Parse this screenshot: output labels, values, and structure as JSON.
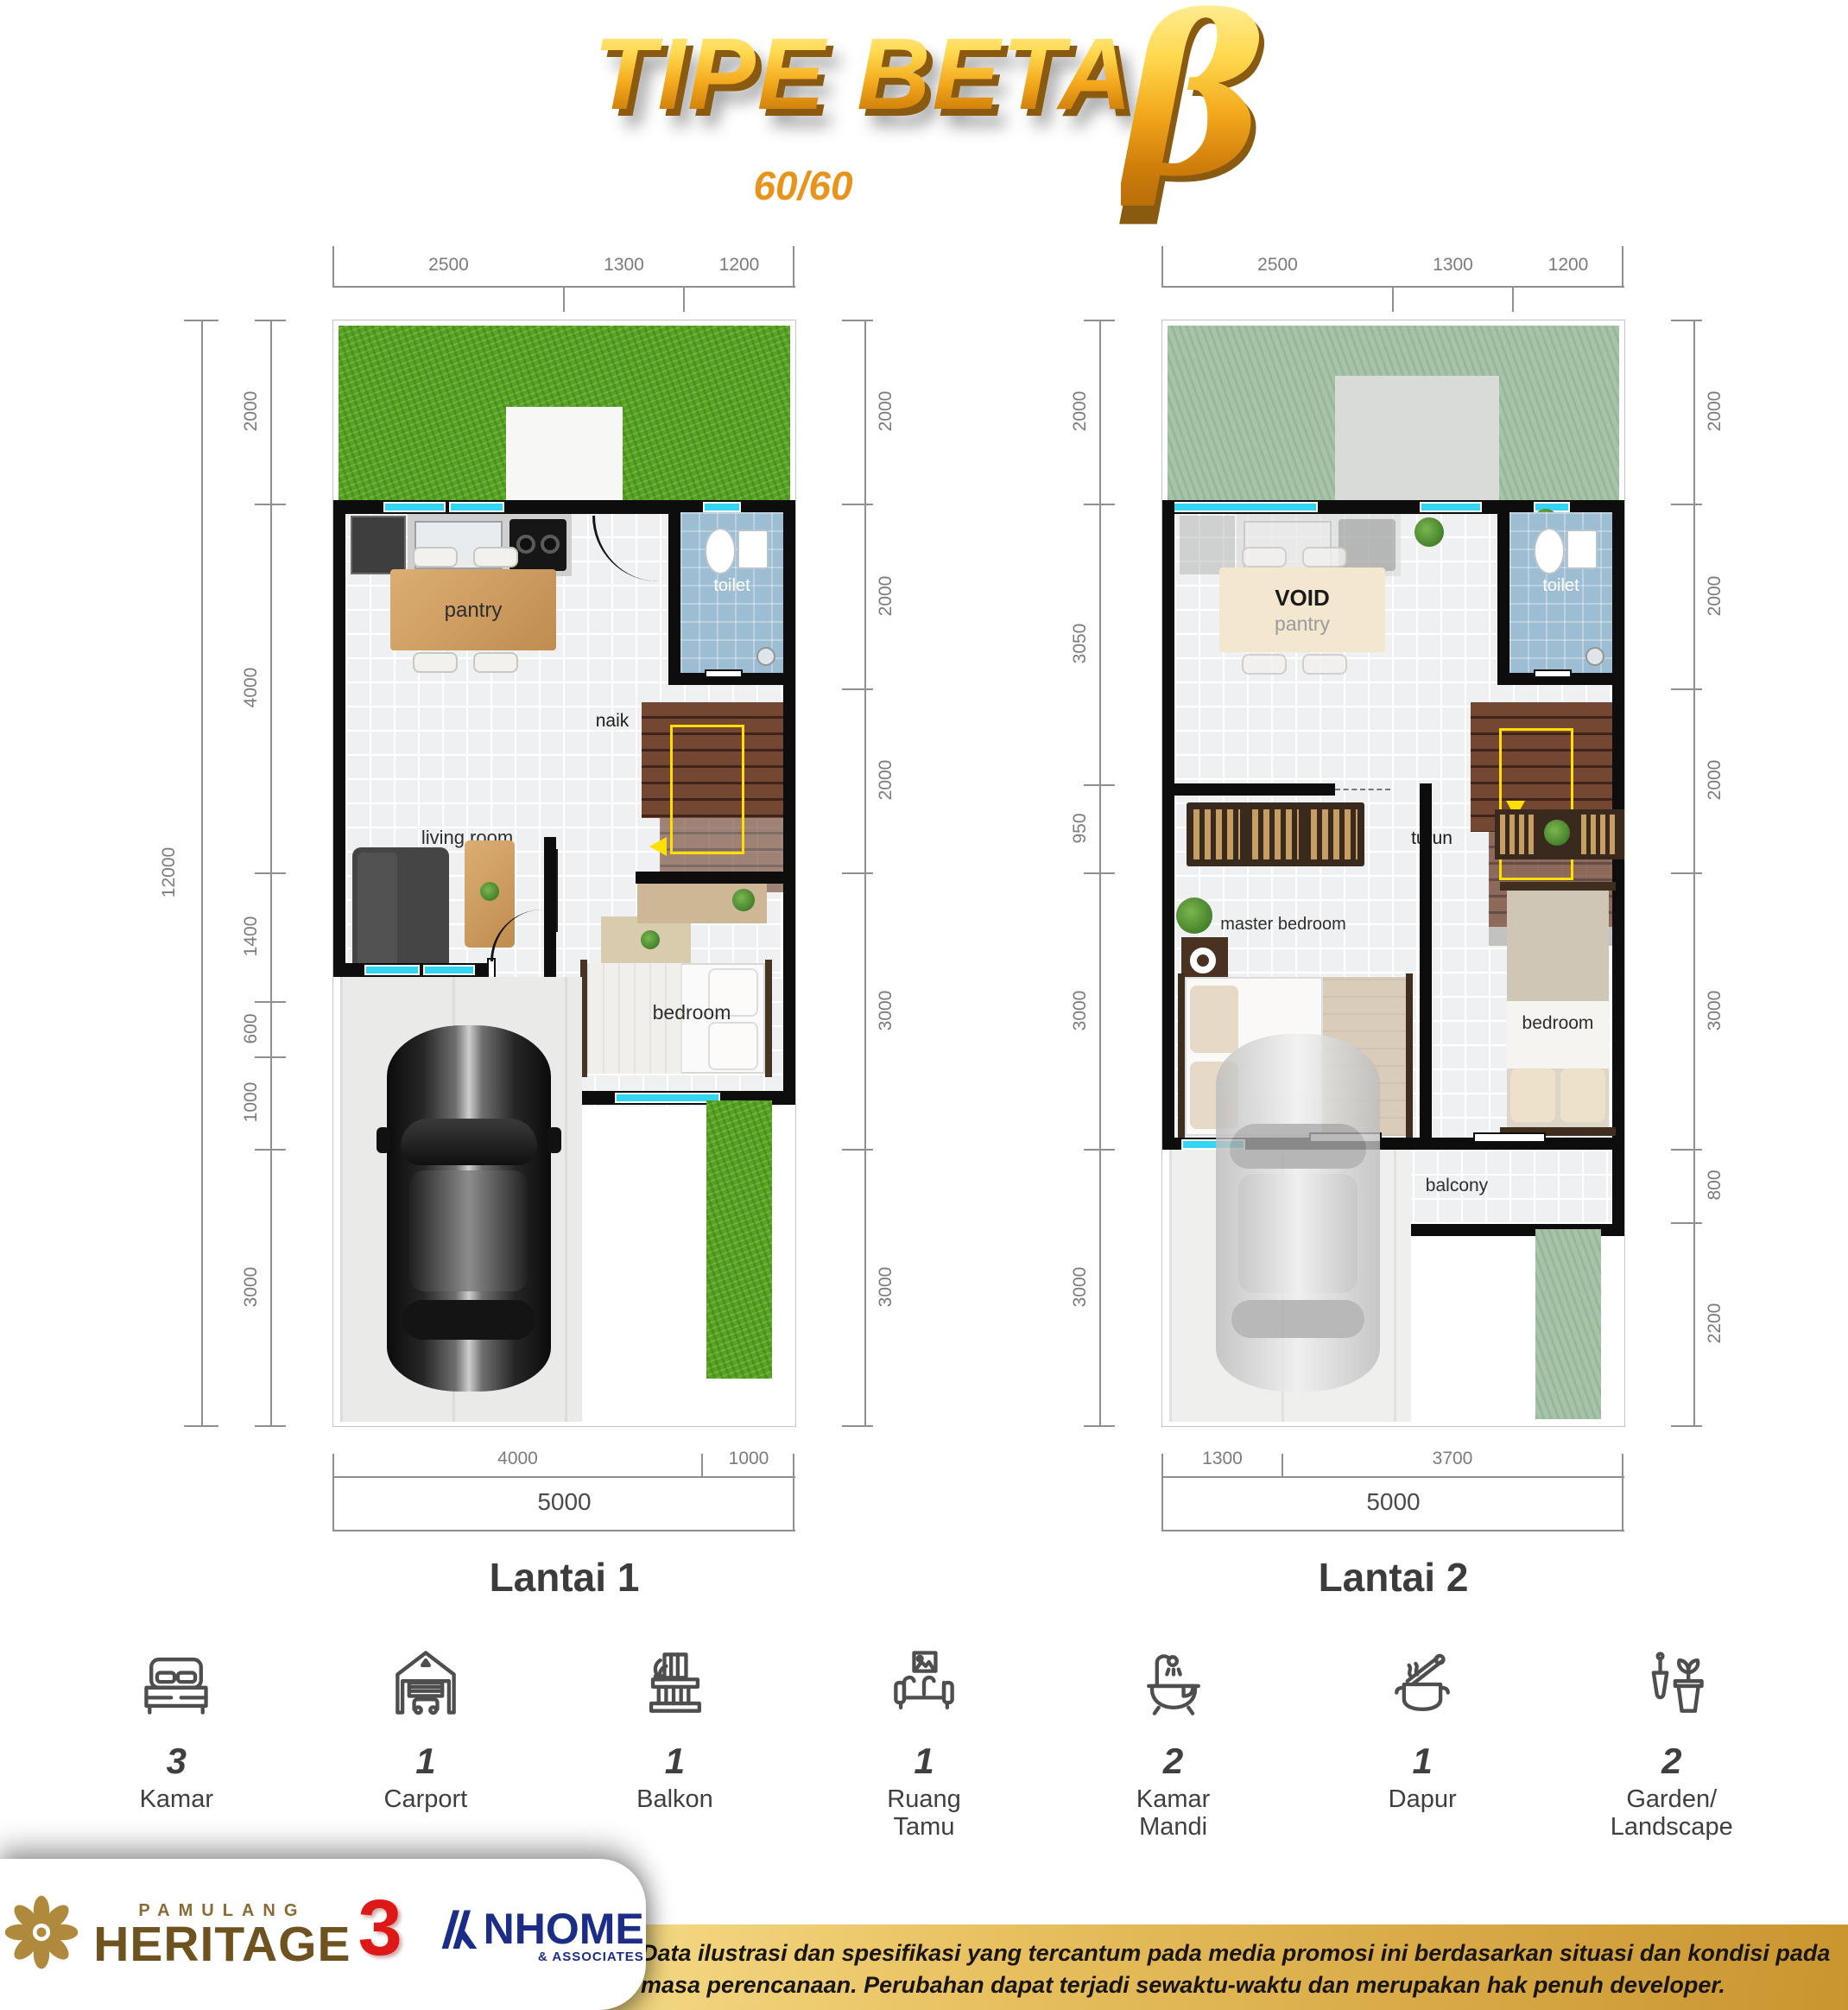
{
  "header": {
    "title": "TIPE BETA",
    "beta": "β",
    "size": "60/60"
  },
  "plan1": {
    "name": "Lantai 1",
    "dims_top": [
      "2500",
      "1300",
      "1200"
    ],
    "total_height": "12000",
    "dims_left": [
      "2000",
      "4000",
      "1400",
      "600",
      "1000",
      "3000"
    ],
    "dims_right": [
      "2000",
      "2000",
      "2000",
      "3000",
      "3000"
    ],
    "dims_bottom": [
      "4000",
      "1000"
    ],
    "total_width": "5000",
    "labels": {
      "pantry": "pantry",
      "toilet": "toilet",
      "stairs": "naik",
      "living": "living room",
      "bedroom": "bedroom"
    }
  },
  "plan2": {
    "name": "Lantai 2",
    "dims_top": [
      "2500",
      "1300",
      "1200"
    ],
    "dims_left": [
      "2000",
      "3050",
      "950",
      "3000",
      "3000"
    ],
    "dims_right": [
      "2000",
      "2000",
      "2000",
      "3000",
      "800",
      "2200"
    ],
    "dims_bottom": [
      "1300",
      "3700"
    ],
    "total_width": "5000",
    "labels": {
      "void": "VOID",
      "pantry": "pantry",
      "toilet": "toilet",
      "stairs": "turun",
      "master": "master bedroom",
      "bedroom": "bedroom",
      "balcony": "balcony"
    }
  },
  "features": [
    {
      "count": "3",
      "label": "Kamar"
    },
    {
      "count": "1",
      "label": "Carport"
    },
    {
      "count": "1",
      "label": "Balkon"
    },
    {
      "count": "1",
      "label": "Ruang Tamu"
    },
    {
      "count": "2",
      "label": "Kamar Mandi"
    },
    {
      "count": "1",
      "label": "Dapur"
    },
    {
      "count": "2",
      "label": "Garden/ Landscape"
    }
  ],
  "footer": {
    "brand_top": "PAMULANG",
    "brand_main": "HERITAGE",
    "brand_number": "3",
    "partner_main": "NHOME",
    "partner_sub": "& ASSOCIATES",
    "disclaimer": "Data ilustrasi dan spesifikasi yang tercantum pada media promosi ini berdasarkan situasi dan kondisi pada masa perencanaan. Perubahan dapat terjadi sewaktu-waktu dan merupakan hak penuh developer."
  },
  "colors": {
    "title_gold": "#f3a81c",
    "accent_orange": "#e8941c",
    "window_cyan": "#34d5f3",
    "wall_black": "#0d0d0d",
    "grass_green": "#58a226",
    "grass_muted": "#a7c4a9",
    "toilet_blue": "#9dbdd2",
    "stair_brown": "#734732",
    "dim_gray": "#7b7b7b",
    "navy": "#1b2d86",
    "heritage_brown": "#6e521f",
    "brand_red": "#de1717",
    "gold_band": "#e7bf5e"
  }
}
